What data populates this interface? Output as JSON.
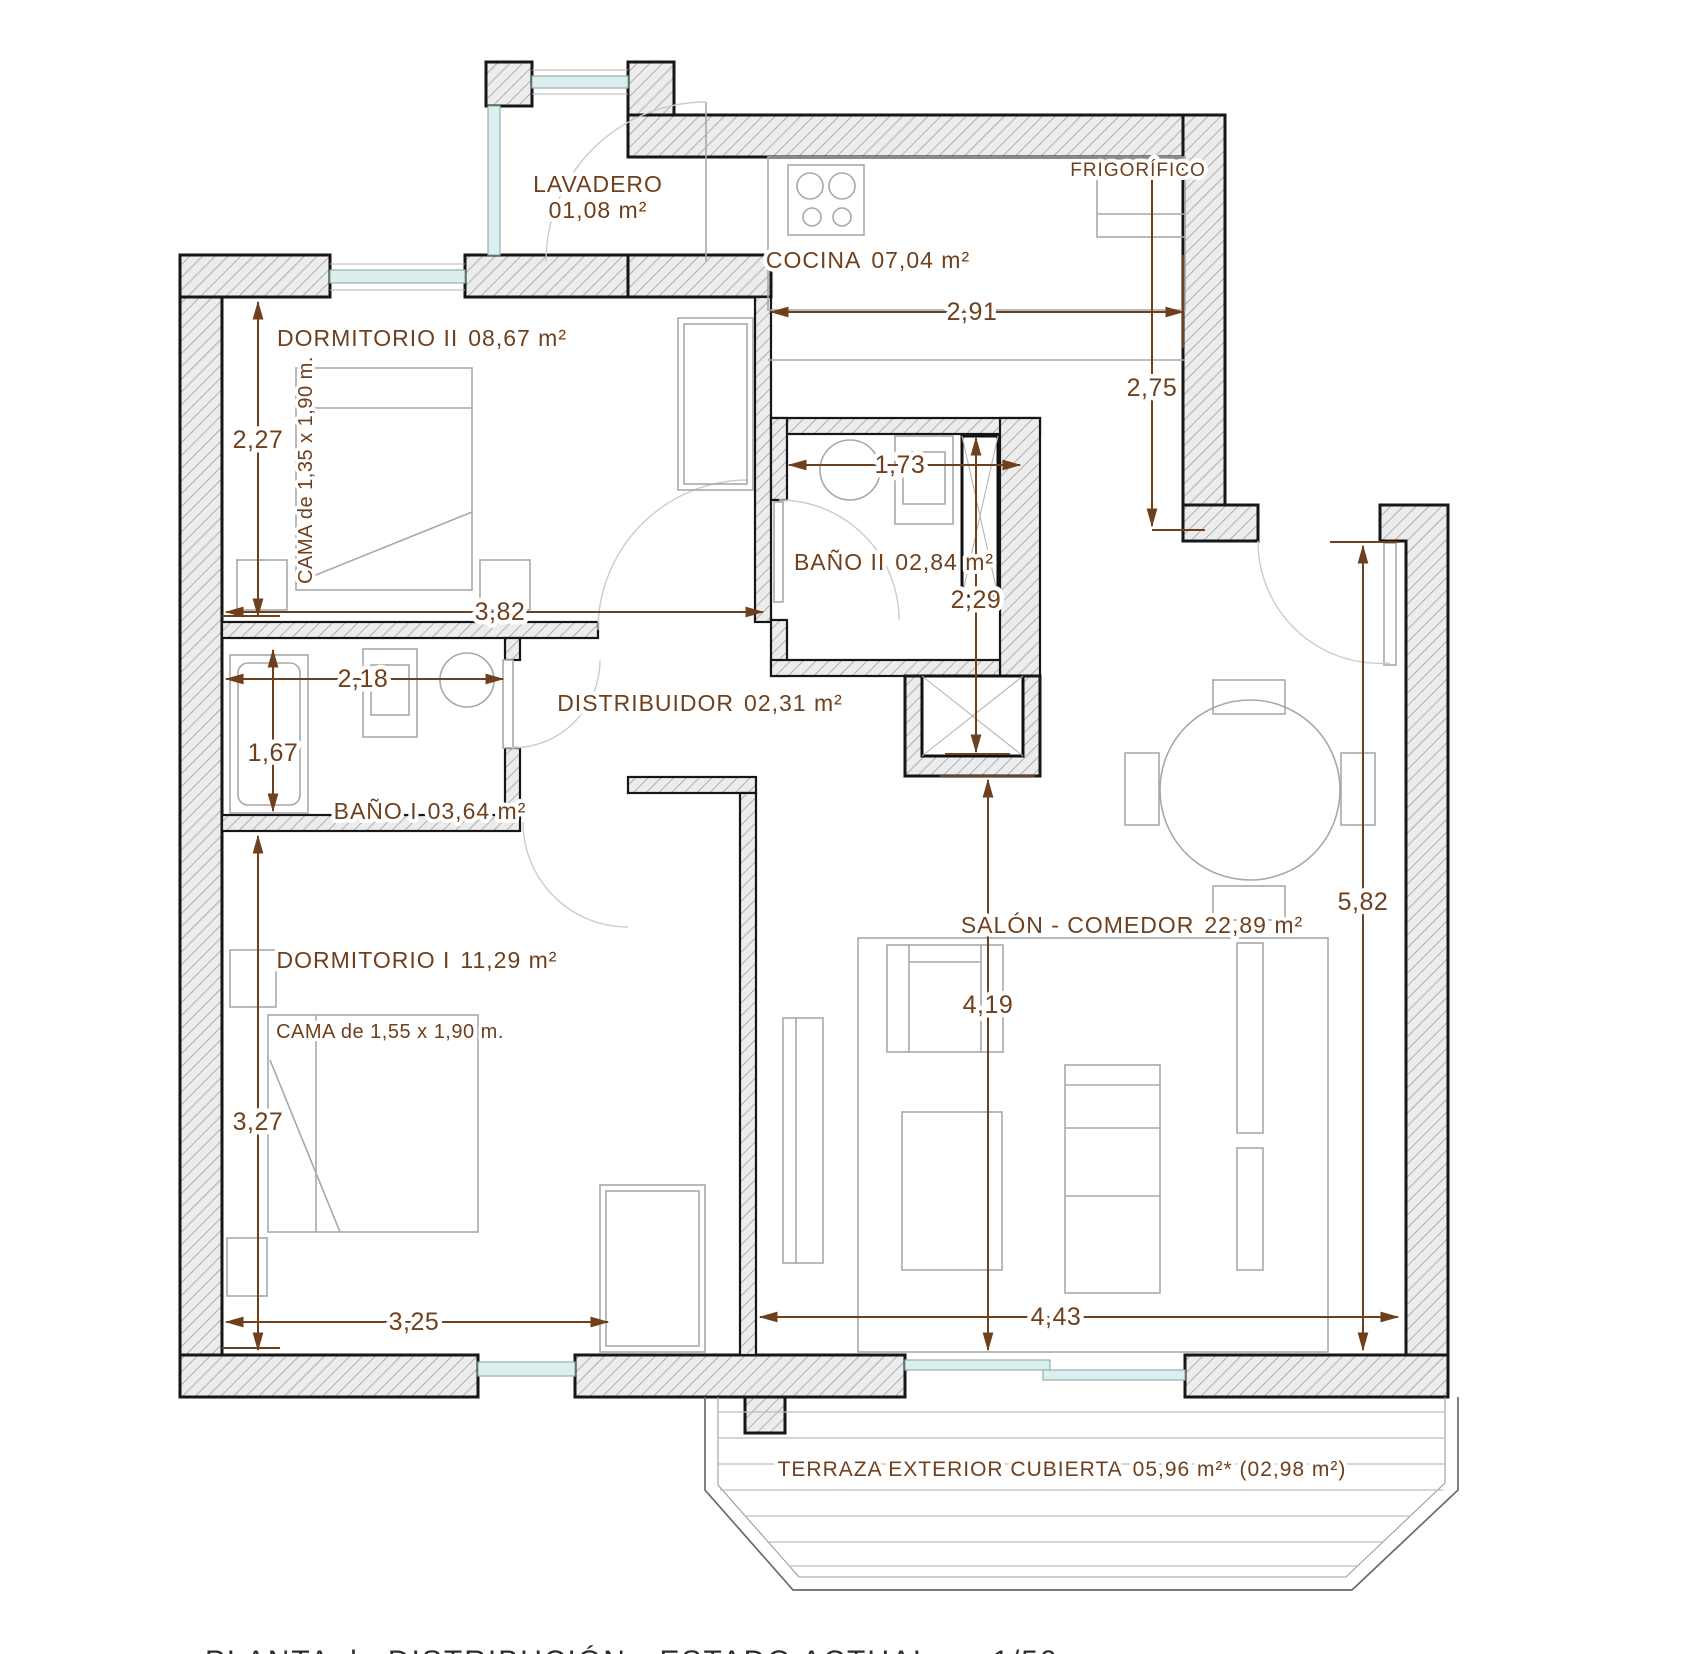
{
  "plan": {
    "colors": {
      "accent": "#6f401d",
      "wall_outline": "#161616",
      "hatch_line": "#8f8f8f",
      "furniture_line": "#a8a8a8",
      "glazing": "#dceeed"
    },
    "rooms": [
      {
        "id": "lavadero",
        "label": "LAVADERO",
        "area": "01,08 m²"
      },
      {
        "id": "cocina",
        "label": "COCINA",
        "area": "07,04 m²"
      },
      {
        "id": "dormitorio-2",
        "label": "DORMITORIO II",
        "area": "08,67 m²"
      },
      {
        "id": "bano-2",
        "label": "BAÑO II",
        "area": "02,84 m²"
      },
      {
        "id": "distribuidor",
        "label": "DISTRIBUIDOR",
        "area": "02,31 m²"
      },
      {
        "id": "bano-1",
        "label": "BAÑO I",
        "area": "03,64 m²"
      },
      {
        "id": "dormitorio-1",
        "label": "DORMITORIO I",
        "area": "11,29 m²"
      },
      {
        "id": "salon",
        "label": "SALÓN - COMEDOR",
        "area": "22,89 m²"
      },
      {
        "id": "terraza",
        "label": "TERRAZA EXTERIOR CUBIERTA",
        "area": "05,96 m²* (02,98 m²)"
      }
    ],
    "annotations": [
      {
        "id": "frigorifico",
        "label": "FRIGORÍFICO"
      },
      {
        "id": "cama-2",
        "label": "CAMA de 1,35 x 1,90 m."
      },
      {
        "id": "cama-1",
        "label": "CAMA de 1,55 x 1,90 m."
      }
    ],
    "dimensions": [
      {
        "id": "cocina-ancho",
        "value": "2,91"
      },
      {
        "id": "cocina-alto",
        "value": "2,75"
      },
      {
        "id": "dormitorio2-alto",
        "value": "2,27"
      },
      {
        "id": "dormitorio2-ancho",
        "value": "3,82"
      },
      {
        "id": "bano2-ancho",
        "value": "1,73"
      },
      {
        "id": "bano2-alto",
        "value": "2,29"
      },
      {
        "id": "bano1-ancho",
        "value": "2,18"
      },
      {
        "id": "bano1-alto",
        "value": "1,67"
      },
      {
        "id": "salon-alto",
        "value": "5,82"
      },
      {
        "id": "salon-centro",
        "value": "4,19"
      },
      {
        "id": "dormitorio1-alto",
        "value": "3,27"
      },
      {
        "id": "dormitorio1-ancho",
        "value": "3,25"
      },
      {
        "id": "salon-ancho",
        "value": "4,43"
      }
    ],
    "footer": {
      "title": "PLANTA de DISTRIBUCIÓN - ESTADO ACTUAL - e 1/50"
    }
  }
}
